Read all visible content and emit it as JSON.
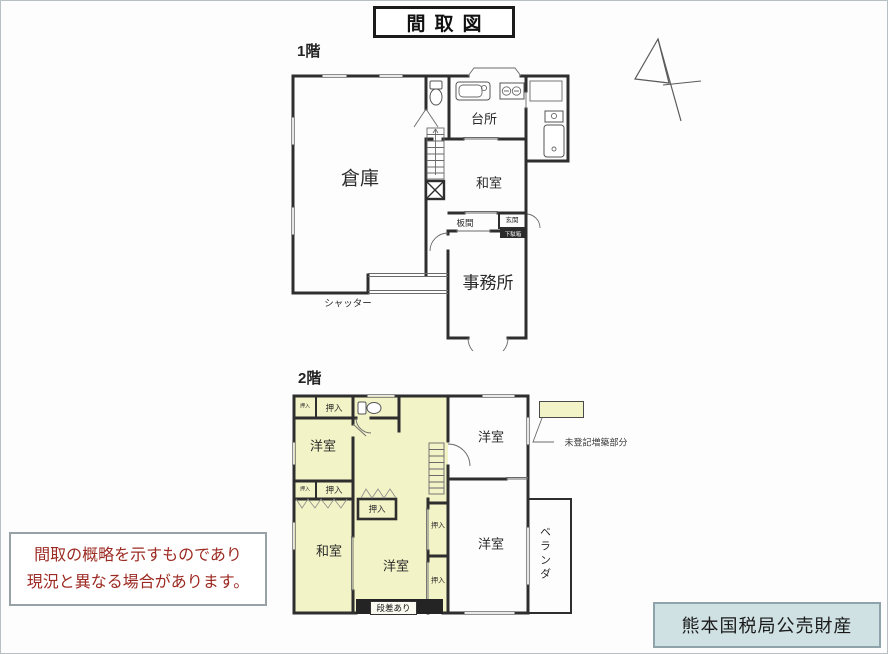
{
  "title": "間取図",
  "floor1": {
    "label": "1階",
    "rooms": {
      "souko": "倉庫",
      "daidokoro": "台所",
      "washitsu": "和室",
      "itanoma": "板間",
      "genkan": "玄関",
      "shoe_cabinet": "下駄箱",
      "jimusho": "事務所"
    },
    "shutter_label": "シャッター"
  },
  "floor2": {
    "label": "2階",
    "rooms": {
      "yoshitsu": "洋室",
      "washitsu": "和室",
      "oshiire": "押入",
      "veranda": "ベランダ",
      "dansa_ari": "段差あり"
    },
    "legend_label": "未登記増築部分",
    "highlight_color": "#f2f3c6"
  },
  "disclaimer": {
    "line1": "間取の概略を示すものであり",
    "line2": "現況と異なる場合があります。",
    "text_color": "#9c2a22"
  },
  "credit": {
    "text": "熊本国税局公売財産",
    "bg_color": "#cfe1e3"
  }
}
